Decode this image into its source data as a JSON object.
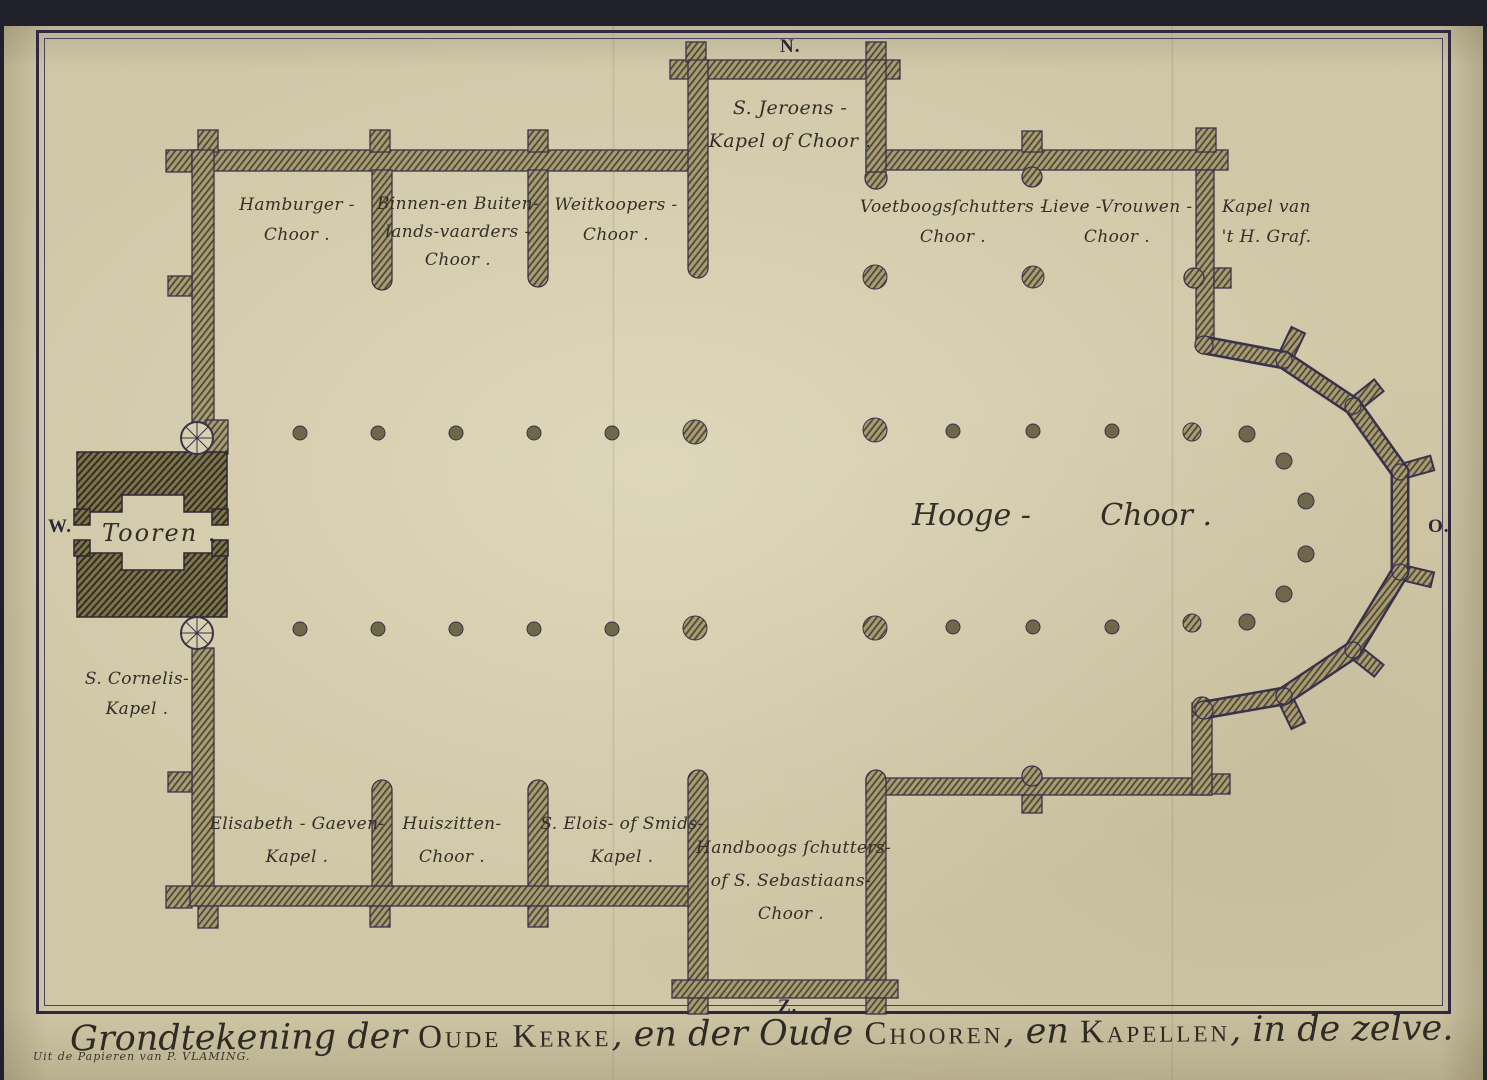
{
  "colors": {
    "paper": "#cfc7a6",
    "ink_outline": "#39324e",
    "wall_fill": "#a79c76",
    "wall_hatch": "#4f4930",
    "tower_fill": "#7d734f",
    "dark_top_band": "#20202a",
    "text": "#332f28"
  },
  "compass": {
    "north": "N.",
    "south": "Z.",
    "west": "W.",
    "east": "O."
  },
  "rooms": {
    "jeroens": [
      "S. Jeroens -",
      "Kapel of Choor ."
    ],
    "hamburger": [
      "Hamburger -",
      "Choor ."
    ],
    "binnen": [
      "Binnen-en Buiten-",
      "lands-vaarders -",
      "Choor ."
    ],
    "weitkoopers": [
      "Weitkoopers -",
      "Choor ."
    ],
    "voetboogs": [
      "Voetboogsſchutters -",
      "Choor ."
    ],
    "lieve": [
      "Lieve -Vrouwen -",
      "Choor ."
    ],
    "hgraf": [
      "Kapel van",
      "'t H. Graf."
    ],
    "tooren": "Tooren .",
    "hooge": [
      "Hooge -",
      "Choor ."
    ],
    "cornelis": [
      "S. Cornelis-",
      "Kapel ."
    ],
    "elisabeth": [
      "Elisabeth - Gaeven-",
      "Kapel ."
    ],
    "huiszitten": [
      "Huiszitten-",
      "Choor ."
    ],
    "elois": [
      "S. Elois- of Smids-",
      "Kapel ."
    ],
    "handboogs": [
      "Handboogs ſchutters-",
      "of S. Sebastiaans-",
      "Choor ."
    ]
  },
  "title": {
    "seg1": "Grondtekening der ",
    "seg2": "Oude Kerke",
    "seg3": ", en der Oude ",
    "seg4": "Chooren",
    "seg5": ", en ",
    "seg6": "Kapellen",
    "seg7": ", in de zelve."
  },
  "credit": "Uit de Papieren van P. VLAMING."
}
